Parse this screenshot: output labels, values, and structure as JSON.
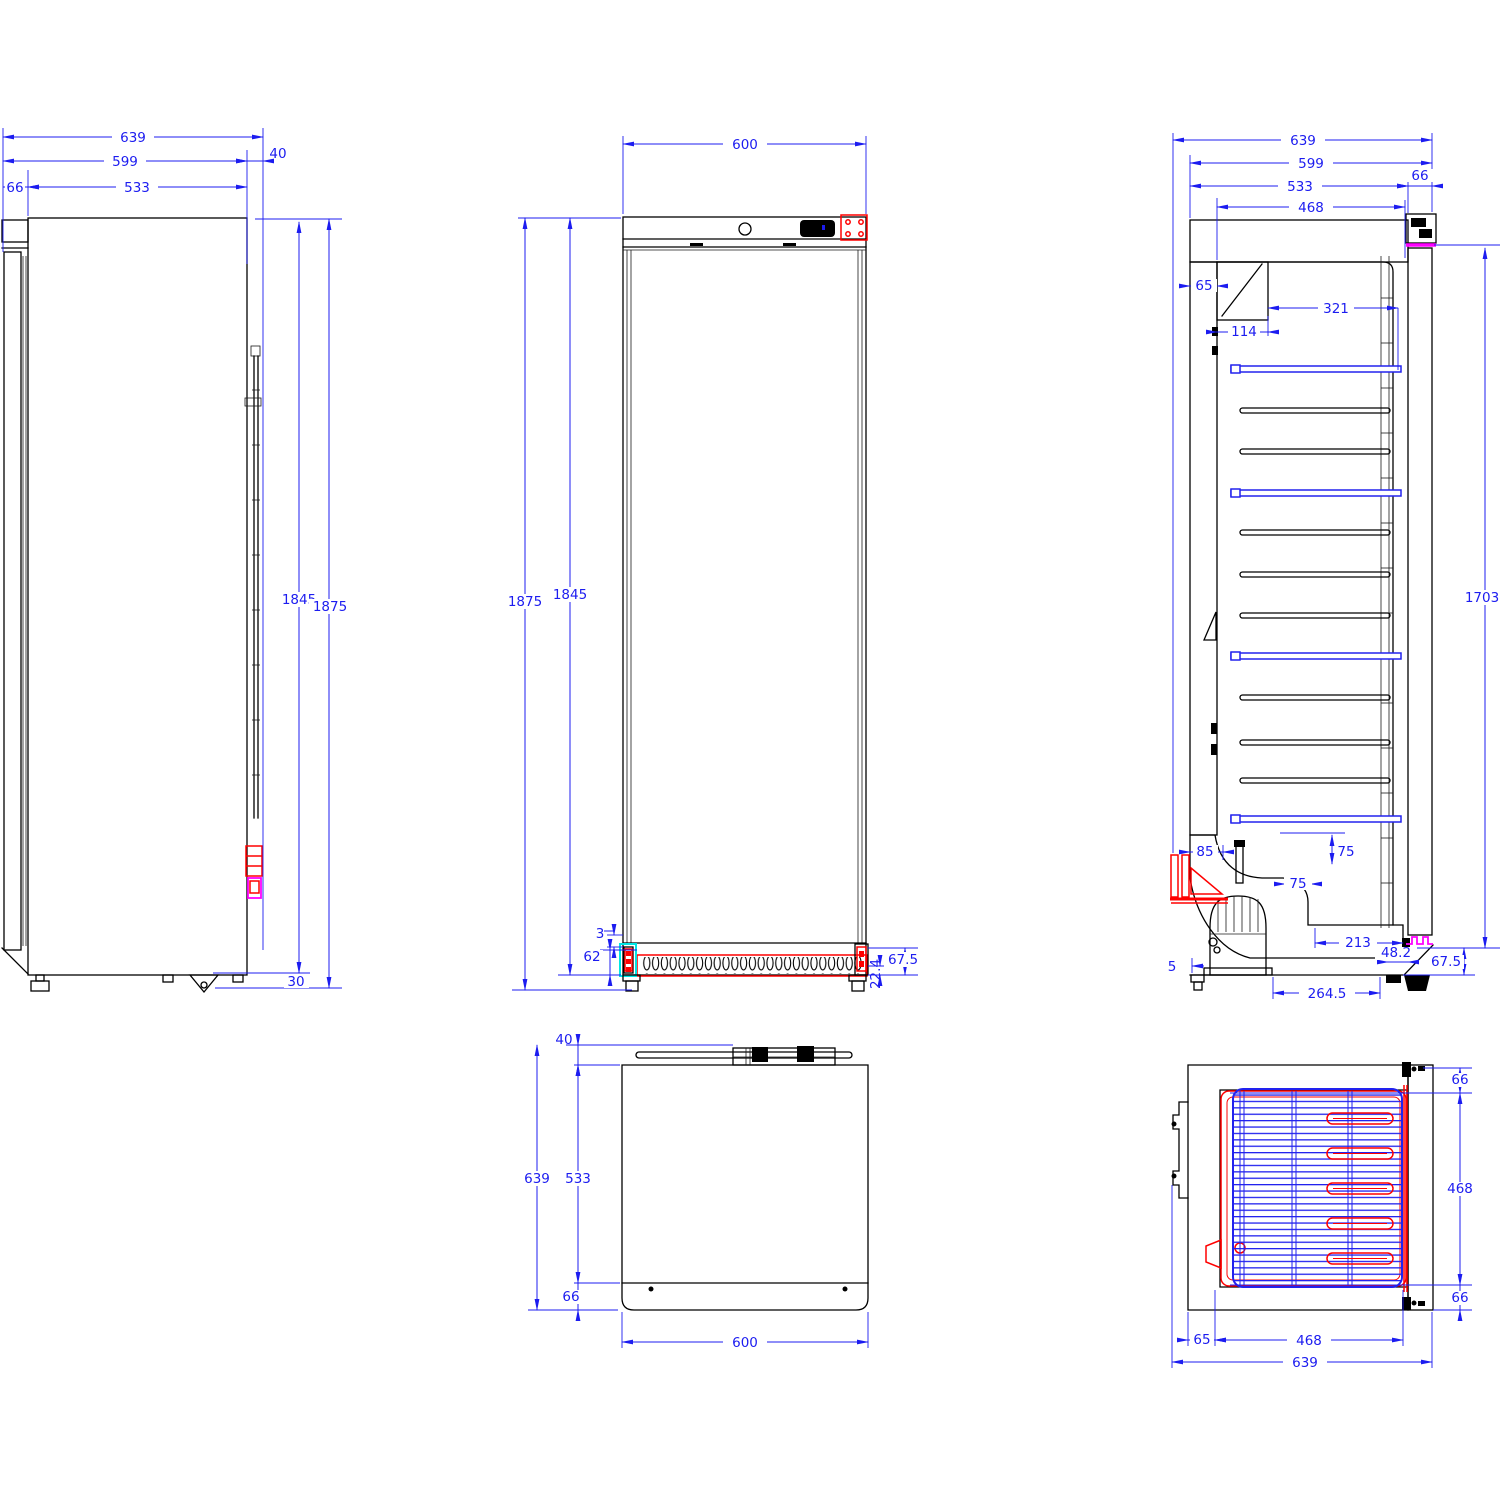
{
  "drawing": {
    "type": "technical-drawing",
    "subject": "upright refrigerator cabinet, 5 orthographic views",
    "units": "mm",
    "colors": {
      "dimension_blue": "#1c1cf0",
      "line_black": "#000000",
      "insulation_hatch_red": "#ff0000",
      "gasket_magenta": "#ff00ff",
      "hinge_highlight_cyan": "#00e5e5",
      "shelf_blue": "#2222ee"
    }
  },
  "views": {
    "side": {
      "label": "side view",
      "d639": "639",
      "d599": "599",
      "d40": "40",
      "d66": "66",
      "d533": "533",
      "d1845": "1845",
      "d1875": "1875",
      "d30": "30"
    },
    "front": {
      "label": "front view",
      "d600": "600",
      "d1875": "1875",
      "d1845": "1845",
      "d3": "3",
      "d62": "62",
      "d67_5": "67.5",
      "d22_4": "22.4"
    },
    "section": {
      "label": "vertical cross-section",
      "d639": "639",
      "d599": "599",
      "d533": "533",
      "d66": "66",
      "d468": "468",
      "d65": "65",
      "d321": "321",
      "d114": "114",
      "d1703": "1703",
      "d85": "85",
      "d75v": "75",
      "d75h": "75",
      "d213": "213",
      "d48_2": "48.2",
      "d67_5": "67.5",
      "d5": "5",
      "d264_5": "264.5"
    },
    "top": {
      "label": "top view",
      "d40": "40",
      "d639": "639",
      "d533": "533",
      "d66": "66",
      "d600": "600"
    },
    "plan": {
      "label": "horizontal plan section",
      "d66_front": "66",
      "d468_side": "468",
      "d66_back": "66",
      "d65": "65",
      "d468_bottom": "468",
      "d639": "639"
    }
  }
}
